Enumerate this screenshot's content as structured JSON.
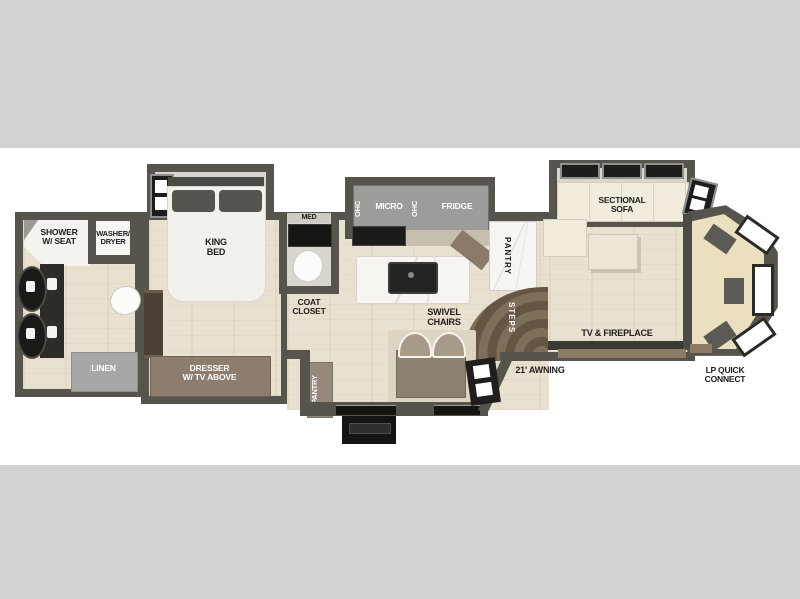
{
  "diagram_type": "rv-floorplan",
  "labels": {
    "shower": {
      "line1": "SHOWER",
      "line2": "W/ SEAT"
    },
    "washer_dryer": {
      "line1": "WASHER/",
      "line2": "DRYER"
    },
    "king_bed": {
      "line1": "KING",
      "line2": "BED"
    },
    "med": "MED",
    "overhead_cabinet_left": "OHC",
    "micro": "MICRO",
    "overhead_cabinet_right": "OHC",
    "fridge": "FRIDGE",
    "pantry_kitchen": "PANTRY",
    "sectional_sofa": {
      "line1": "SECTIONAL",
      "line2": "SOFA"
    },
    "linen": "LINEN",
    "dresser": {
      "line1": "DRESSER",
      "line2": "W/ TV ABOVE"
    },
    "coat_closet": {
      "line1": "COAT",
      "line2": "CLOSET"
    },
    "pantry_entry": "PANTRY",
    "swivel_chairs": {
      "line1": "SWIVEL",
      "line2": "CHAIRS"
    },
    "steps": "STEPS",
    "tv_fireplace": "TV & FIREPLACE",
    "awning": "21' AWNING",
    "lp_quick_connect": {
      "line1": "LP QUICK",
      "line2": "CONNECT"
    }
  },
  "colors": {
    "background_band": "#d2d2d2",
    "wall": "#56544c",
    "floor": "#e9e1d0",
    "slideout_floor": "#d8d6ce",
    "cabinet_gray": "#9c9c9a",
    "linen_gray": "#a7a7a5",
    "dresser_brown": "#8d7d6e",
    "steps_brown": "#645643",
    "sofa_cream": "#f1ecdd",
    "rear_cream": "#eadfbe",
    "text_dark": "#1d1d1b",
    "text_light": "#ffffff"
  }
}
